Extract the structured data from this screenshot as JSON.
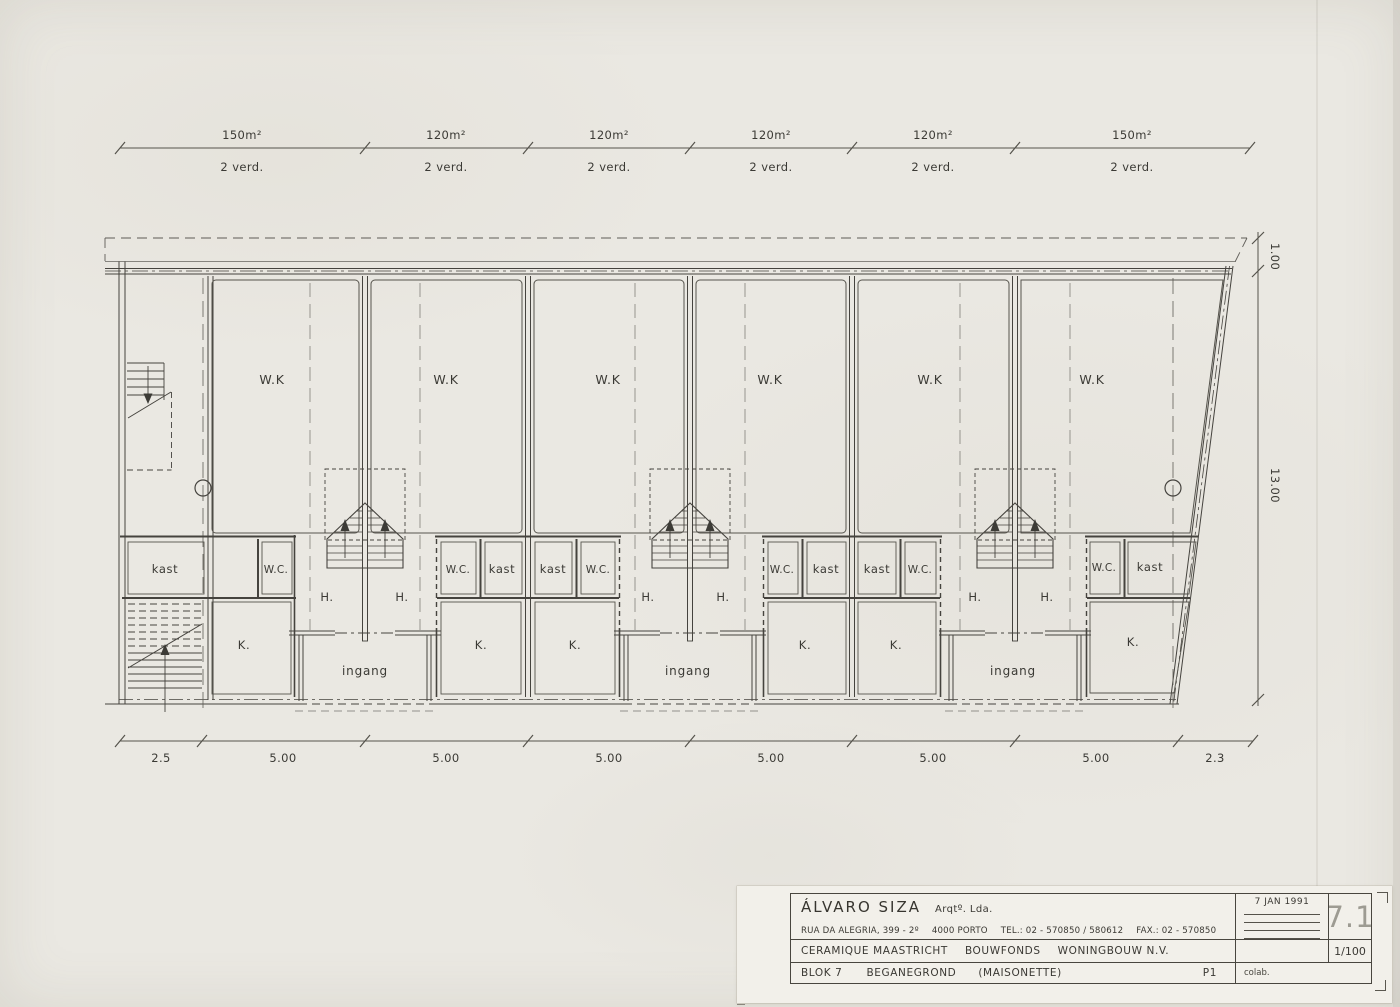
{
  "plan": {
    "top_dimensions": [
      {
        "area": "150m²",
        "floors": "2 verd."
      },
      {
        "area": "120m²",
        "floors": "2 verd."
      },
      {
        "area": "120m²",
        "floors": "2 verd."
      },
      {
        "area": "120m²",
        "floors": "2 verd."
      },
      {
        "area": "120m²",
        "floors": "2 verd."
      },
      {
        "area": "150m²",
        "floors": "2 verd."
      }
    ],
    "bottom_dimensions": [
      "2.5",
      "5.00",
      "5.00",
      "5.00",
      "5.00",
      "5.00",
      "5.00",
      "2.3"
    ],
    "right_dimensions": {
      "offset": "1.00",
      "depth": "13.00"
    },
    "living_rooms": [
      "W.K",
      "W.K",
      "W.K",
      "W.K",
      "W.K",
      "W.K"
    ],
    "closets": [
      "kast",
      "kast",
      "kast",
      "kast",
      "kast",
      "kast"
    ],
    "toilets": [
      "W.C.",
      "W.C.",
      "W.C.",
      "W.C.",
      "W.C.",
      "W.C."
    ],
    "kitchens": [
      "K.",
      "K.",
      "K.",
      "K.",
      "K.",
      "K."
    ],
    "halls": [
      "H.",
      "H.",
      "H.",
      "H.",
      "H.",
      "H."
    ],
    "entrances": [
      "ingang",
      "ingang",
      "ingang"
    ]
  },
  "title_block": {
    "architect": "ÁLVARO SIZA",
    "architect_suffix": "Arqtº. Lda.",
    "address_street": "RUA DA ALEGRIA, 399 - 2º",
    "address_city": "4000 PORTO",
    "tel": "TEL.: 02 - 570850 / 580612",
    "fax": "FAX.: 02 - 570850",
    "project_client": "CERAMIQUE MAASTRICHT",
    "project_developer": "BOUWFONDS",
    "project_company": "WONINGBOUW N.V.",
    "block": "BLOK 7",
    "floor": "BEGANEGROND",
    "type": "(MAISONETTE)",
    "phase": "P1",
    "date": "7 JAN 1991",
    "sheet_number": "7.1",
    "scale": "1/100",
    "collaborator": "colab."
  }
}
